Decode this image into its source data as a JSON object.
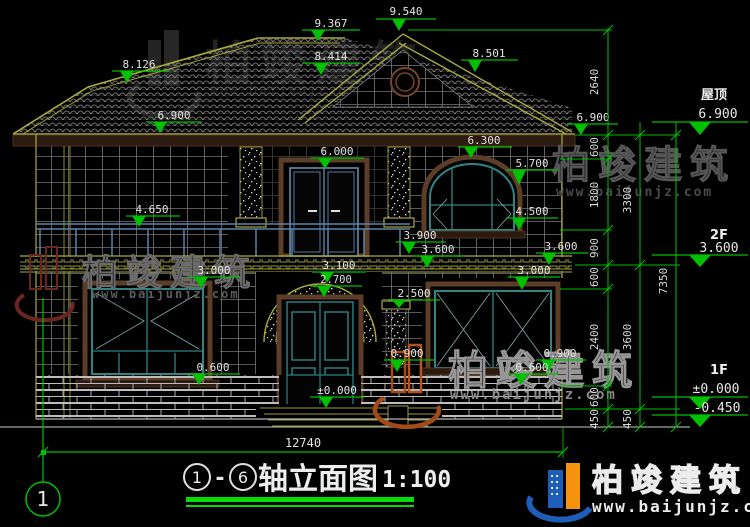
{
  "brand": {
    "name": "柏竣建筑",
    "url": "www.baijunjz.com"
  },
  "levels": {
    "v9367": "9.367",
    "v9540": "9.540",
    "v8126": "8.126",
    "v8414": "8.414",
    "v8501": "8.501",
    "v6900_left": "6.900",
    "v6900_inner": "6.900",
    "v6300": "6.300",
    "v6000": "6.000",
    "v5700": "5.700",
    "v4650": "4.650",
    "v4500": "4.500",
    "v3900": "3.900",
    "v3600_center": "3.600",
    "v3600_right": "3.600",
    "v3100": "3.100",
    "v3000_left": "3.000",
    "v3000_right": "3.000",
    "v2700": "2.700",
    "v2500": "2.500",
    "v0900_left": "0.900",
    "v0900_right": "0.900",
    "v0600_left": "0.600",
    "v0600_right": "0.600",
    "v0000_door": "±0.000"
  },
  "floors": {
    "roof_label": "屋顶",
    "roof_value": "6.900",
    "f2_label": "2F",
    "f2_value": "3.600",
    "f1_label": "1F",
    "f1_value": "±0.000",
    "ground_value": "-0.450"
  },
  "dims": {
    "inner": [
      "2640",
      "600",
      "1800",
      "900",
      "600",
      "2400",
      "600",
      "450"
    ],
    "mid": [
      "3300",
      "3600",
      "450"
    ],
    "overall_height": "7350",
    "overall_width": "12740"
  },
  "title": {
    "axis_from": "1",
    "axis_to": "6",
    "separator": "-",
    "text": "轴立面图",
    "scale": "1:100"
  },
  "axis_bubble": "1"
}
